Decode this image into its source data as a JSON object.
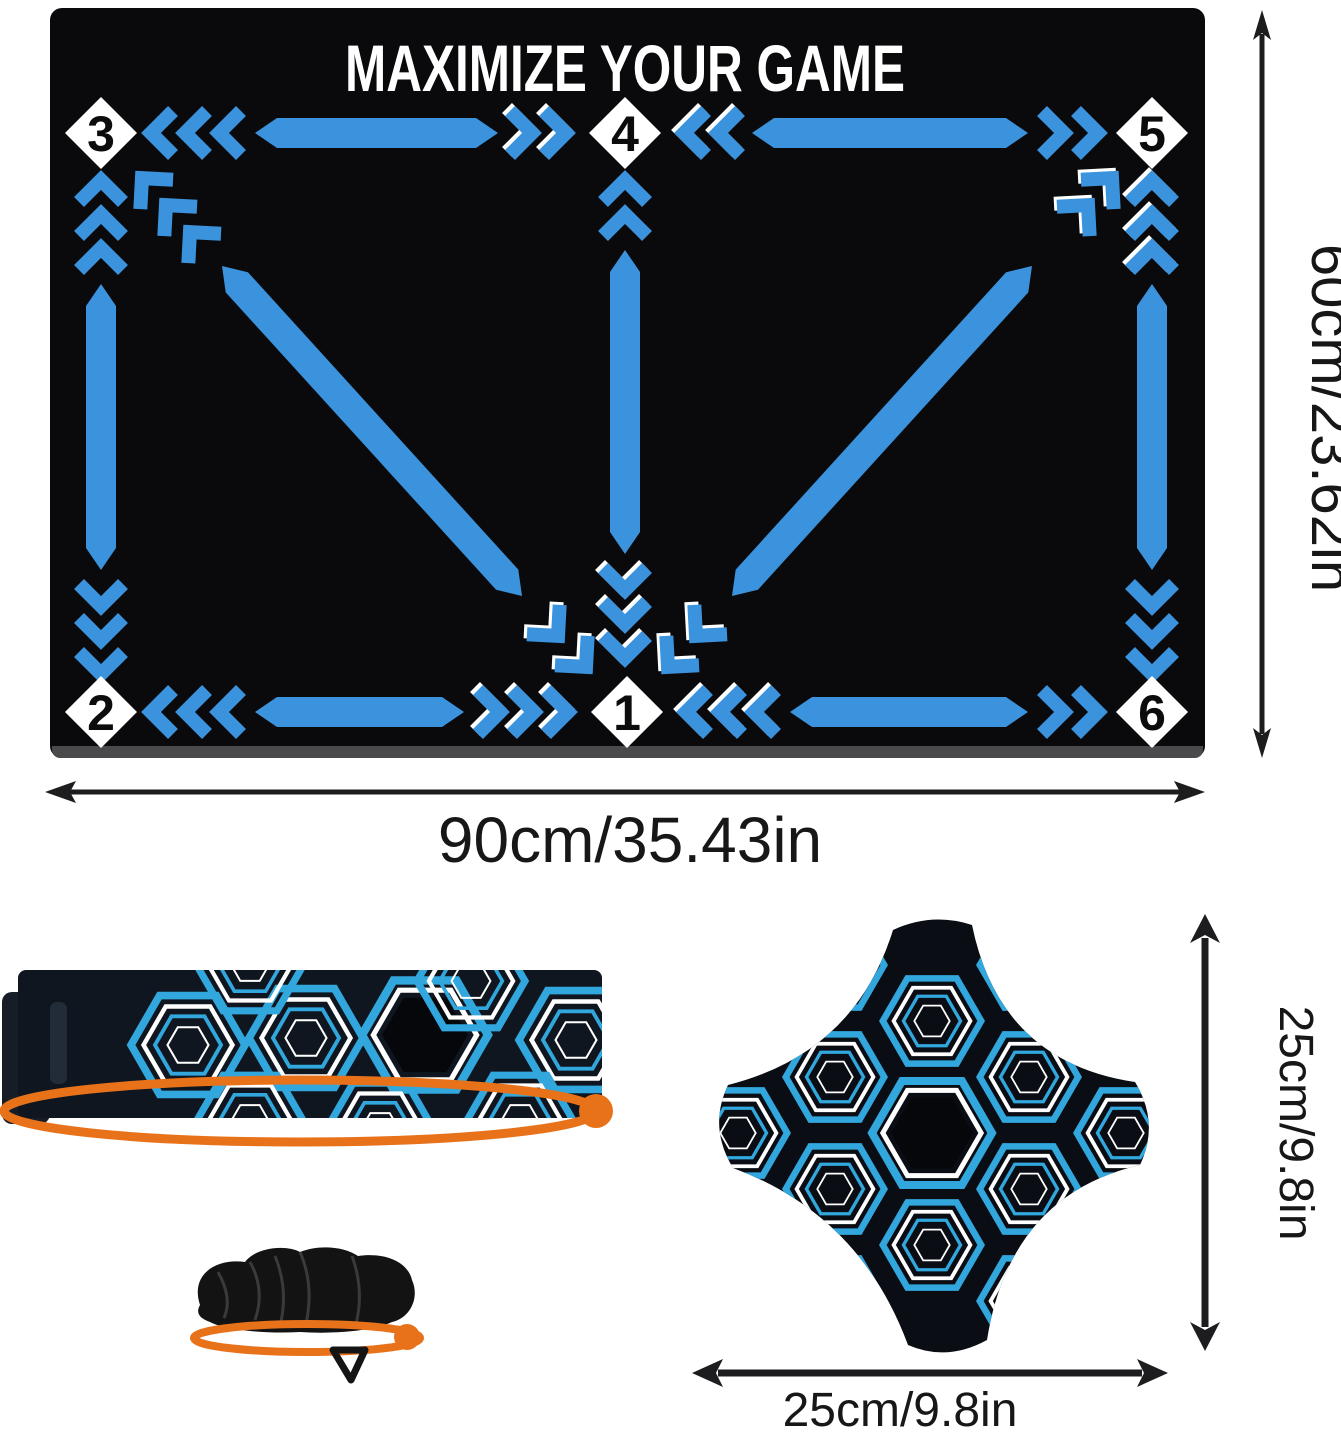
{
  "mat": {
    "title": "MAXIMIZE YOUR GAME",
    "stations": [
      {
        "number": "3"
      },
      {
        "number": "4"
      },
      {
        "number": "5"
      },
      {
        "number": "2"
      },
      {
        "number": "1"
      },
      {
        "number": "6"
      }
    ],
    "dimensions": {
      "width_label": "90cm/35.43in",
      "height_label": "60cm/23.62in"
    },
    "colors": {
      "surface": "#0a0a0c",
      "arrow_blue": "#3b93dd",
      "marker_white": "#ffffff"
    }
  },
  "kick_trainer": {
    "pad_dimensions": {
      "width_label": "25cm/9.8in",
      "height_label": "25cm/9.8in"
    },
    "colors": {
      "fabric_black": "#0c1018",
      "pattern_blue": "#31a7dd",
      "pattern_white": "#ffffff",
      "highlight_orange": "#e8721a"
    }
  }
}
